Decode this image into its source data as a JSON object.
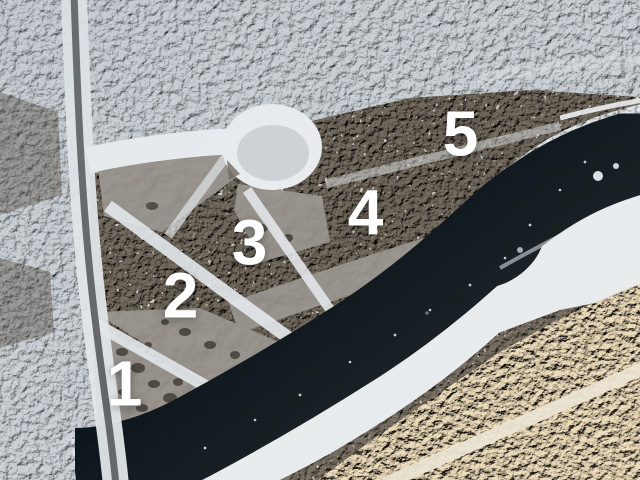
{
  "photo": {
    "description": "Aerial winter drone photograph of five numbered wooded riverfront lots, with an access road, cul-de-sac, cleared lot-line strips and a dark open river winding past snowy banks",
    "season": "winter"
  },
  "lots": [
    {
      "id": "lot-1",
      "number": "1"
    },
    {
      "id": "lot-2",
      "number": "2"
    },
    {
      "id": "lot-3",
      "number": "3"
    },
    {
      "id": "lot-4",
      "number": "4"
    },
    {
      "id": "lot-5",
      "number": "5"
    }
  ],
  "colors": {
    "snow_forest": "#ccd2d7",
    "lot_forest": "#756c5f",
    "open_ground": "#99948e",
    "river_water": "#12161b",
    "bank_snow": "#e2e7eb",
    "beach_snow": "#e9edf0",
    "sunlit_snow": "#ecdfc6",
    "road_surface": "#55595c",
    "clearing_snow": "#e3e7ea",
    "label_text": "#ffffff"
  }
}
